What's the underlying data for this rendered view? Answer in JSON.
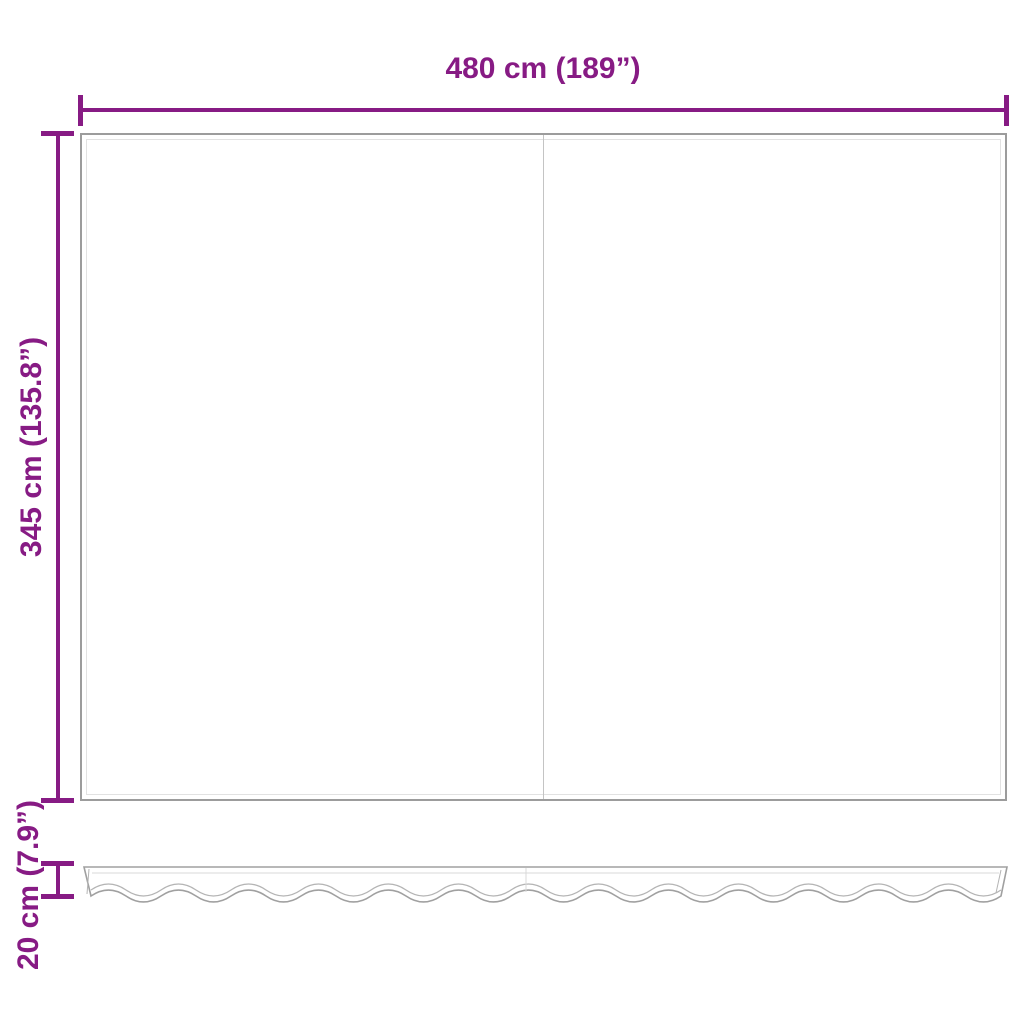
{
  "diagram": {
    "width_label": "480 cm (189”)",
    "height_label": "345 cm (135.8”)",
    "valance_height_label": "20 cm (7.9”)"
  },
  "colors": {
    "dimension_line": "#871b84",
    "panel_outline": "#9c9c9c",
    "inner_seam": "#e2e2e2",
    "center_seam": "#c4c4c4",
    "valance_outline": "#a0a0a0",
    "valance_seam": "#b4b4b4",
    "light_seam": "#d9d9d9",
    "background": "#ffffff"
  }
}
